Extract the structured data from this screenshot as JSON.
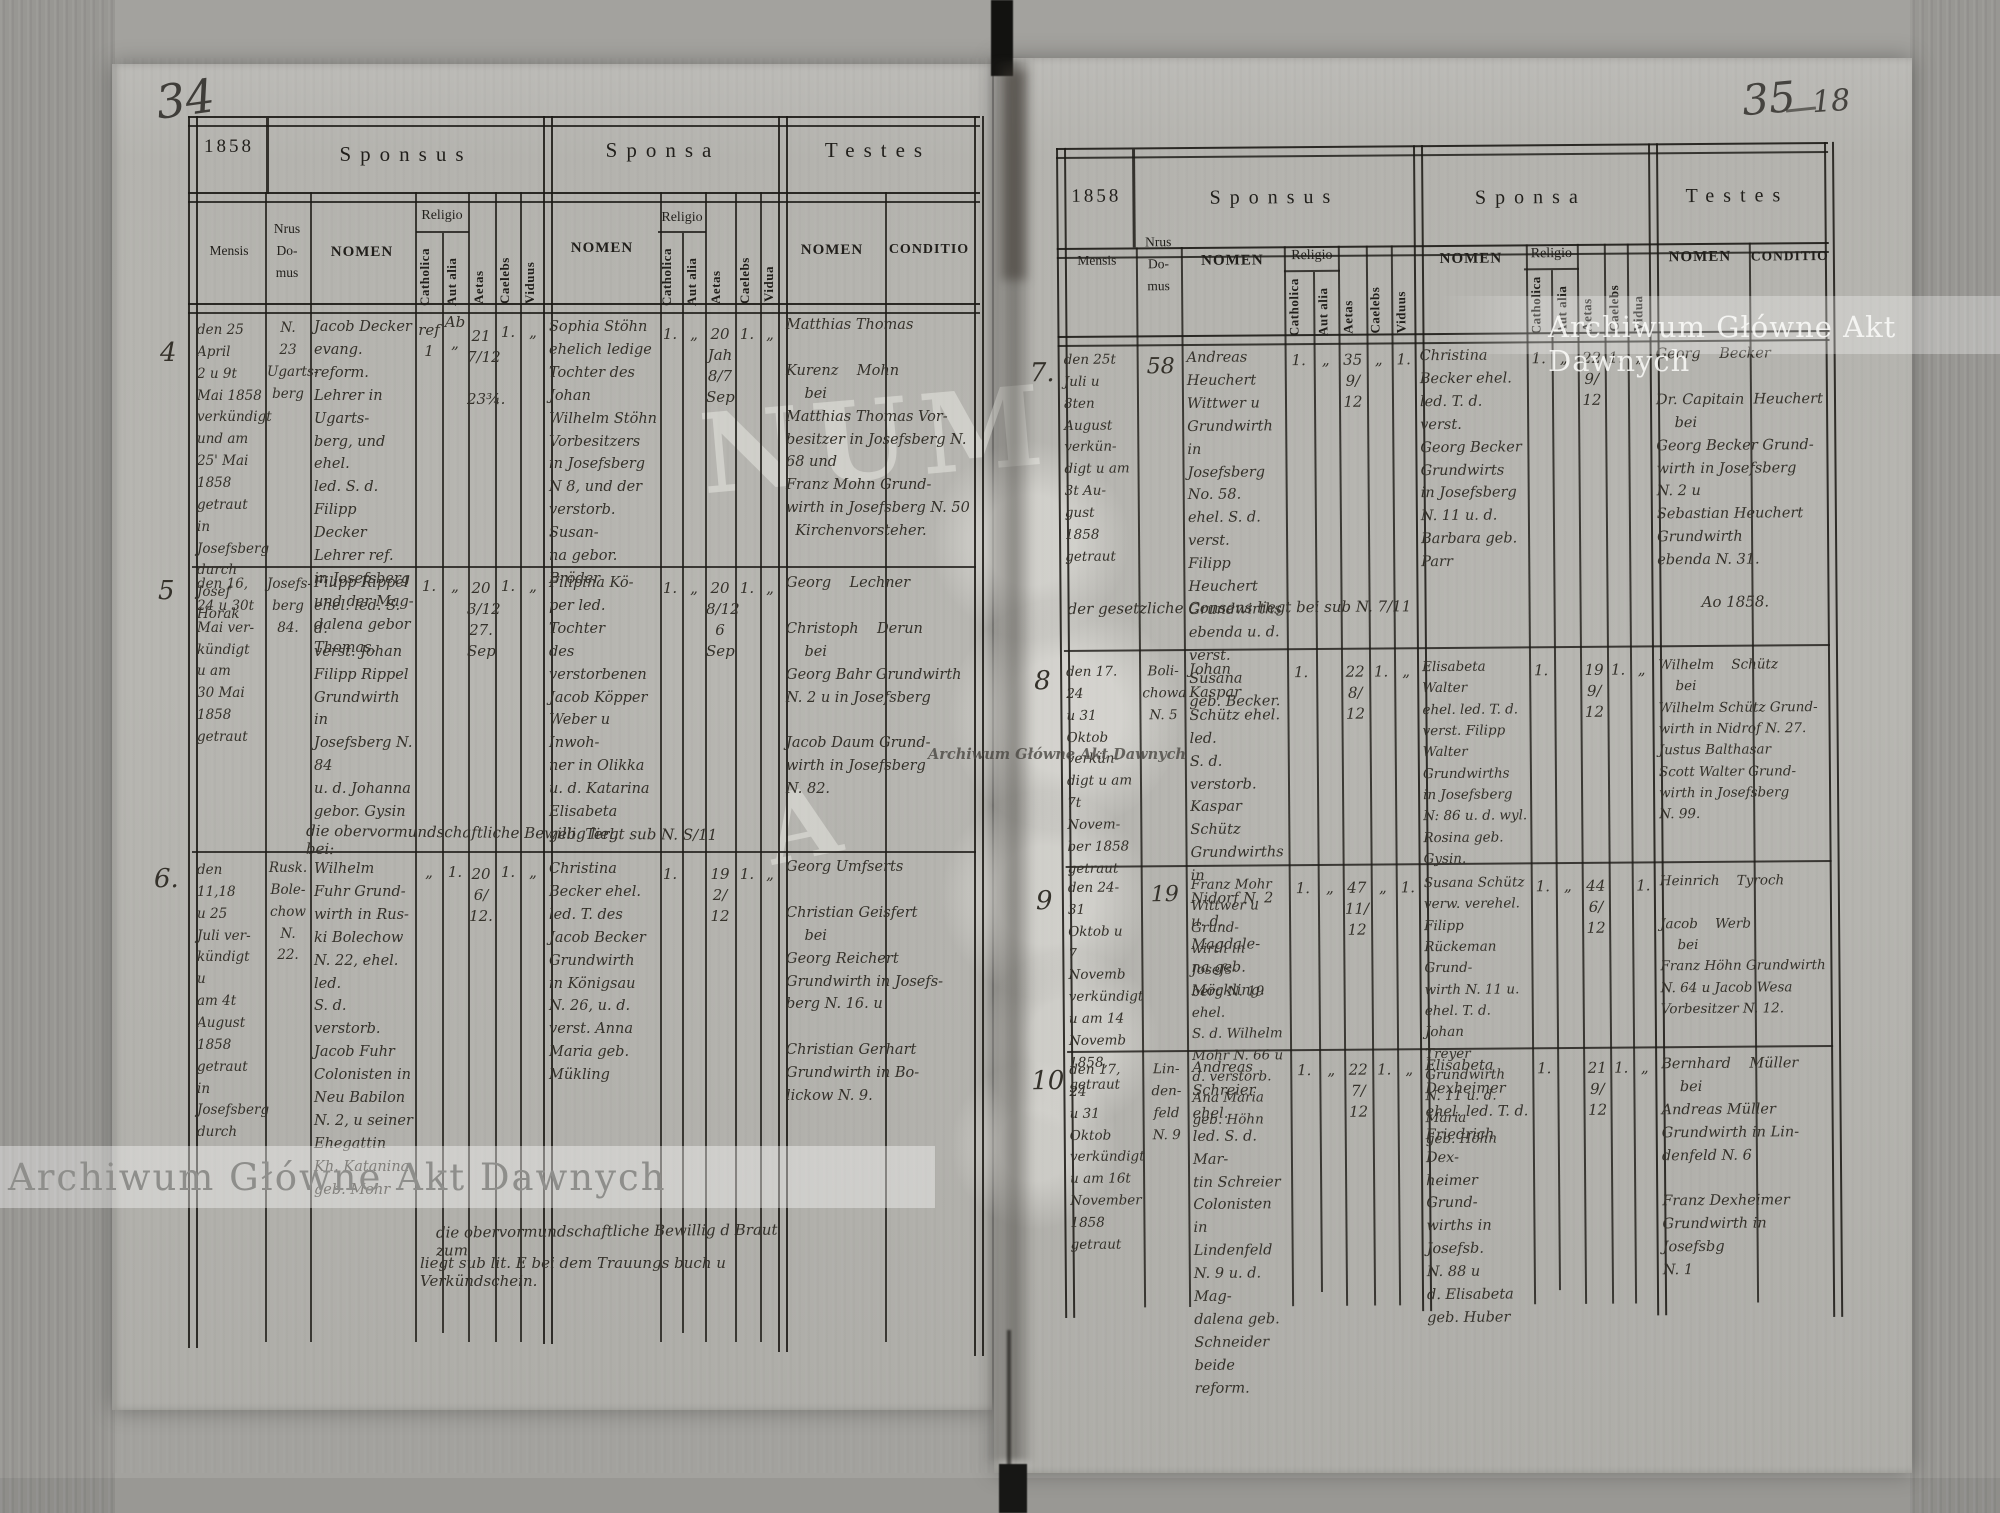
{
  "scan": {
    "left_page_number": "34",
    "right_page_number": "35",
    "right_folio_number": "18"
  },
  "watermark": {
    "text": "Archiwum Główne Akt Dawnych",
    "ghost_letters_1": "NUM",
    "ghost_letters_2": "A"
  },
  "labels": {
    "year": "1858",
    "sponsus": "Sponsus",
    "sponsa": "Sponsa",
    "testes": "Testes",
    "mensis": "Mensis",
    "nrus": "Nrus",
    "domus1": "Do-",
    "domus2": "mus",
    "nomen": "NOMEN",
    "conditio": "CONDITIO",
    "religio": "Religio",
    "catholica": "Catholica",
    "aut_alia": "Aut alia",
    "aetas": "Aetas",
    "caelebs": "Caelebs",
    "viduus": "Viduus",
    "vidua": "Vidua"
  },
  "left_page": {
    "entries": [
      {
        "no": "4",
        "mensis": "den 25 April\n2 u 9t\nMai 1858\nverkündigt\nund am\n25' Mai\n1858\ngetraut in\nJosefsberg\ndurch\nJosef Horak",
        "domus": "N.\n23\nUgarts-\nberg",
        "sponsus": "Jacob Decker\nevang. reform.\nLehrer in Ugarts-\nberg, und ehel.\nled. S. d. Filipp\nDecker Lehrer ref.\nin Josefsberg\nund der Mag-\ndalena gebor\nThomas.",
        "sp_cath": "ref\n1",
        "sp_aut": "Ab\n„",
        "sp_aetas": "21\n7/12\n\n23¾.",
        "sp_cael": "1.",
        "sp_vid": "„",
        "sponsa": "Sophia Stöhn\nehelich ledige\nTochter des Johan\nWilhelm Stöhn\nVorbesitzers\nin Josefsberg\nN 8, und der\nverstorb. Susan-\nna gebor. Bröder",
        "sa_cath": "1.",
        "sa_aut": "„",
        "sa_aetas": "20\nJah\n8/7\nSep",
        "sa_cael": "1.",
        "sa_vid": "„",
        "testes": "Matthias Thomas\n\nKurenz    Mohn\n    bei\nMatthias Thomas Vor-\nbesitzer in Josefsberg N.\n68 und\nFranz Mohn Grund-\nwirth in Josefsberg N. 50\n  Kirchenvorsteher."
      },
      {
        "no": "5",
        "mensis": "den 16,\n24 u 30t\nMai ver-\nkündigt\nu am\n30 Mai\n1858\ngetraut",
        "domus": "Josefs-\nberg\n84.",
        "sponsus": "Filipp Rippel\nehel. led. S. d.\nverst. Johan\nFilipp Rippel\nGrundwirth in\nJosefsberg N. 84\nu. d. Johanna\ngebor. Gysin",
        "sp_cath": "1.",
        "sp_aut": "„",
        "sp_aetas": "20\n3/12\n27.\nSep",
        "sp_cael": "1.",
        "sp_vid": "„",
        "sponsa": "Filipina Kö-\nper led. Tochter\ndes verstorbenen\nJacob Köpper\nWeber u Inwoh-\nner in Olikka\nu. d. Katarina\nElisabeta\ngeb. Terl.",
        "sa_cath": "1.",
        "sa_aut": "„",
        "sa_aetas": "20\n8/12\n6\nSep",
        "sa_cael": "1.",
        "sa_vid": "„",
        "testes": "Georg    Lechner\n\nChristoph    Derun\n    bei\nGeorg Bahr Grundwirth\nN. 2 u in Josefsberg\n\nJacob Daum Grund-\nwirth in Josefsberg\nN. 82."
      },
      {
        "no": "6.",
        "mensis": "den 11,18\nu 25\nJuli ver-\nkündigt\nu\nam 4t\nAugust\n1858\ngetraut\nin\nJosefsberg\ndurch",
        "domus": "Rusk.\nBole-\nchow\nN.\n22.",
        "sponsus": "Wilhelm\nFuhr Grund-\nwirth in Rus-\nki Bolechow\nN. 22, ehel. led.\nS. d. verstorb.\nJacob Fuhr\nColonisten in\nNeu Babilon\nN. 2, u seiner\nEhegattin\nKh. Katanina\ngeb. Mohr",
        "sp_cath": "„",
        "sp_aut": "1.",
        "sp_aetas": "20\n6/\n12.",
        "sp_cael": "1.",
        "sp_vid": "„",
        "sponsa": "Christina\nBecker ehel.\nled. T. des\nJacob Becker\nGrundwirth\nin Königsau\nN. 26, u. d.\nverst. Anna\nMaria geb.\nMükling",
        "sa_cath": "1.",
        "sa_aut": "",
        "sa_aetas": "19\n2/\n12",
        "sa_cael": "1.",
        "sa_vid": "„",
        "testes": "Georg Umfserts\n\nChristian Geisfert\n    bei\nGeorg Reichert\nGrundwirth in Josefs-\nberg N. 16. u\n\nChristian Gerhart\nGrundwirth in Bo-\nlickow N. 9."
      }
    ],
    "note_row5": "die obervormundschaftliche Bewillig liegt sub N. S/11 bei:",
    "note_row6_line1": "die obervormundschaftliche Bewillig d Braut zum",
    "note_row6_line2": "liegt sub lit. E bei dem Trauungs buch u Verkündschein."
  },
  "right_page": {
    "entries": [
      {
        "no": "7.",
        "mensis": "den 25t\nJuli u\n8ten\nAugust\nverkün-\ndigt u am\n3t Au-\ngust 1858\ngetraut",
        "domus": "58",
        "sponsus": "Andreas\nHeuchert\nWittwer u\nGrundwirth\nin Josefsberg\nNo. 58.\nehel. S. d. verst.\nFilipp Heuchert\nGrundwirths\nebenda u. d.\nverst. Susana\ngeb. Becker.",
        "sp_cath": "1.",
        "sp_aut": "„",
        "sp_aetas": "35\n9/\n12",
        "sp_cael": "„",
        "sp_vid": "1.",
        "sponsa": "Christina\nBecker ehel.\nled. T. d. verst.\nGeorg Becker\nGrundwirts\nin Josefsberg\nN. 11 u. d.\nBarbara geb.\nParr",
        "sa_cath": "1.",
        "sa_aut": "„",
        "sa_aetas": "22\n9/\n12",
        "sa_cael": "1.",
        "sa_vid": "„",
        "testes": "Georg    Becker\n\nDr. Capitain  Heuchert\n    bei\nGeorg Becker Grund-\nwirth in Josefsberg\nN. 2 u\nSebastian Heuchert\nGrundwirth\nebenda N. 31."
      },
      {
        "no": "8",
        "mensis": "den 17. 24\nu 31 Oktob\nverkün-\ndigt u am\n7t Novem-\nber 1858\ngetraut",
        "domus": "Boli-\nchowa\nN. 5",
        "sponsus": "Johan Kaspar\nSchütz ehel. led.\nS. d. verstorb.\nKaspar Schütz\nGrundwirths in\nNidorf N. 2\nu. d. Magdale-\nna geb. Möckling.",
        "sp_cath": "1.",
        "sp_aut": "",
        "sp_aetas": "22\n8/\n12",
        "sp_cael": "1.",
        "sp_vid": "„",
        "sponsa": "Elisabeta Walter\nehel. led. T. d.\nverst. Filipp\nWalter Grundwirths\nin Josefsberg\nN: 86 u. d. wyl.\nRosina geb.\nGysin.",
        "sa_cath": "1.",
        "sa_aut": "",
        "sa_aetas": "19\n9/\n12",
        "sa_cael": "1.",
        "sa_vid": "„",
        "testes": "Wilhelm    Schütz\n    bei\nWilhelm Schütz Grund-\nwirth in Nidrof N. 27.\nJustus Balthasar\nScott Walter Grund-\nwirth in Josefsberg\nN. 99."
      },
      {
        "no": "9",
        "mensis": "den 24-31\nOktob u\n7 Novemb\nverkündigt\nu am 14\nNovemb\n1858,\ngetraut",
        "domus": "19",
        "sponsus": "Franz Mohr\nWittwer u Grund-\nwirth in Josefs-\nberg N. 19 ehel.\nS. d. Wilhelm\nMohr N. 66 u\nd. verstorb.\nAna Maria\ngeb. Höhn",
        "sp_cath": "1.",
        "sp_aut": "„",
        "sp_aetas": "47\n11/\n12",
        "sp_cael": "„",
        "sp_vid": "1.",
        "sponsa": "Susana Schütz\nverw. verehel. Filipp\nRückeman Grund-\nwirth N. 11 u.\nehel. T. d. Johan\nTreyer Grundwirth\nN. 11 u. d. Maria\ngeb. Höhn",
        "sa_cath": "1.",
        "sa_aut": "„",
        "sa_aetas": "44\n6/\n12",
        "sa_cael": "",
        "sa_vid": "1.",
        "testes": "Heinrich    Tyroch\n\nJacob    Werb\n    bei\nFranz Höhn Grundwirth\nN. 64 u Jacob Wesa\nVorbesitzer N. 12."
      },
      {
        "no": "10",
        "mensis": "den 17, 24\nu 31 Oktob\nverkündigt\nu am 16t\nNovember\n1858\ngetraut",
        "domus": "Lin-\nden-\nfeld\nN. 9",
        "sponsus": "Andreas\nSchreier ehel.\nled. S. d. Mar-\ntin Schreier\nColonisten\nin Lindenfeld\nN. 9 u. d. Mag-\ndalena geb.\nSchneider\nbeide reform.",
        "sp_cath": "1.",
        "sp_aut": "„",
        "sp_aetas": "22\n7/\n12",
        "sp_cael": "1.",
        "sp_vid": "„",
        "sponsa": "Elisabeta\nDexheimer\nehel. led. T. d.\nFriedrich Dex-\nheimer Grund-\nwirths in Josefsb.\nN. 88 u\nd. Elisabeta\ngeb. Huber",
        "sa_cath": "1.",
        "sa_aut": "",
        "sa_aetas": "21\n9/\n12",
        "sa_cael": "1.",
        "sa_vid": "„",
        "testes": "Bernhard    Müller\n    bei\nAndreas Müller\nGrundwirth in Lin-\ndenfeld N. 6\n\nFranz Dexheimer\nGrundwirth in Josefsbg\nN. 1"
      }
    ],
    "note_row7": "der gesetzliche Consens liegt bei sub N. 7/11",
    "note_row7_year": "Ao 1858."
  }
}
